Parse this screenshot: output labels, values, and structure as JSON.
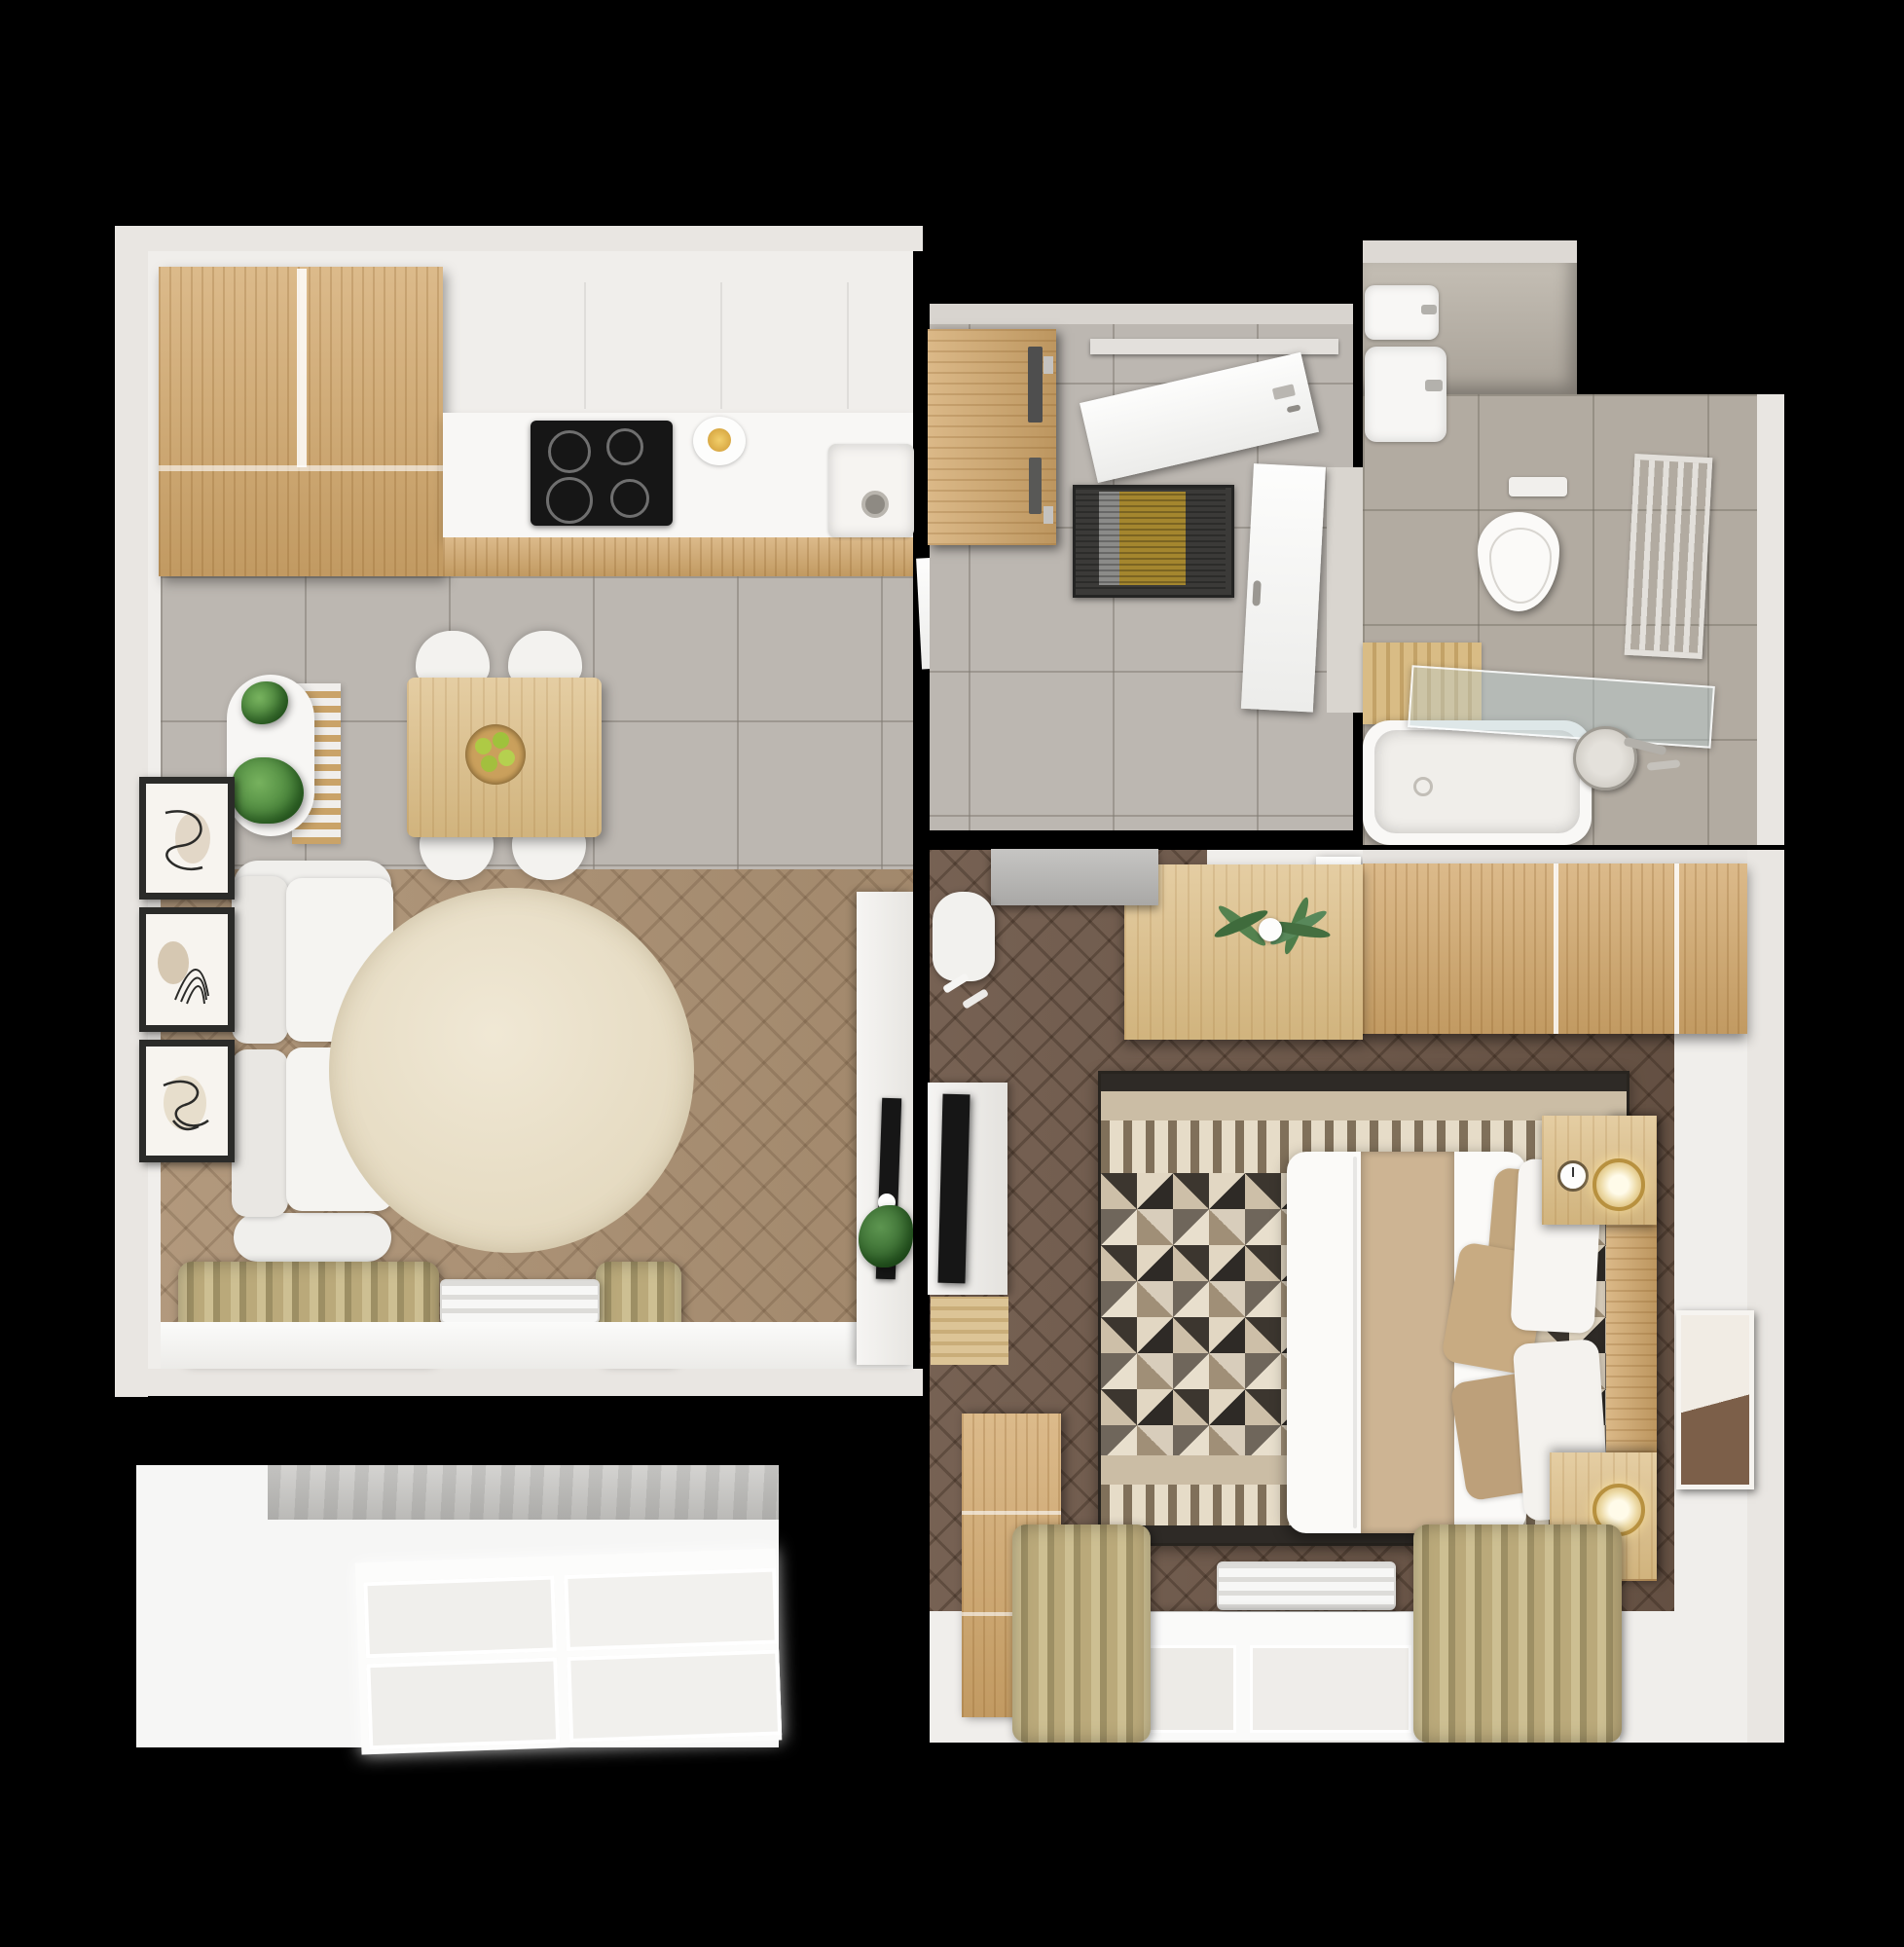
{
  "scene": {
    "type": "top-down 3d rendered apartment floor plan",
    "background": "#000000",
    "rooms_count": 5
  },
  "palette": {
    "bg": "#000000",
    "wall_face": "#e9e6e2",
    "room_wall": "#f0eeeb",
    "tile": "#bcb7b1",
    "bath_tile": "#b2aba1",
    "wood_cabinet": "#d2a76a",
    "wood_desk": "#dcbd84",
    "wood_floor_light": "#ac9173",
    "wood_floor_dark": "#6f594a",
    "counter": "#f8f7f5",
    "appliance_black": "#161616",
    "sofa_white": "#f3f2ef",
    "rug_cream": "#ebe2cd",
    "rug_base": "#d8cdbb",
    "rug_dark": "#2e2a26",
    "bed_white": "#fbfaf8",
    "bed_beige": "#cdb493",
    "pillow_beige": "#c2a67e",
    "curtain_olive": "#b1a274",
    "mat_dark": "#3b3a38",
    "mat_gold": "#b08f2e",
    "mat_gray": "#9a9a98",
    "plant_green": "#4c8040",
    "radiator_white": "#f6f6f5",
    "glass": "#c8dade"
  },
  "rooms": {
    "living_kitchen": {
      "floors": [
        "gray-ceramic-tile",
        "light-chevron-parquet"
      ],
      "objects": [
        "upper-wood-cabinets",
        "white-countertop",
        "induction-cooktop",
        "kitchen-sink",
        "breakfast-plate",
        "dining-table",
        "fruit-bowl-with-apples",
        "dining-chairs-x4",
        "white-console",
        "wood-bench",
        "potted-plants-x2",
        "white-sofa",
        "round-cream-rug",
        "wall-art-frames-x3",
        "window-radiator",
        "olive-curtains",
        "tv-sideboard",
        "living-tv",
        "monstera-plant",
        "window-sill"
      ]
    },
    "hallway": {
      "floors": [
        "gray-ceramic-tile"
      ],
      "objects": [
        "entry-door-open",
        "door-frame",
        "wood-wardrobe",
        "striped-doormat",
        "bathroom-door-open",
        "kitchen-door-open"
      ]
    },
    "bathroom": {
      "floors": [
        "warm-gray-tile"
      ],
      "objects": [
        "vanity-ledge",
        "washbasin",
        "second-basin",
        "wall-hung-toilet",
        "flush-plate",
        "towel-radiator",
        "wooden-bath-mat",
        "bathtub",
        "glass-shower-screen",
        "shower-head",
        "bath-faucet"
      ]
    },
    "bedroom": {
      "floors": [
        "dark-chevron-parquet"
      ],
      "objects": [
        "sliding-wardrobe",
        "wood-desk",
        "palm-plant",
        "gray-console-desk",
        "desk-chair",
        "wall-hooks",
        "tv-cabinet",
        "bedroom-tv",
        "wood-bench-mat",
        "wood-dresser",
        "geometric-rug",
        "double-bed",
        "beige-blanket",
        "pillows-beige-x3",
        "pillows-white-x2",
        "wood-headboard",
        "headboard-shelf-top",
        "headboard-shelf-bottom",
        "bedside-lamps-x2",
        "alarm-clock",
        "window-radiator",
        "window",
        "olive-curtains-x2",
        "wall-picture",
        "open-white-door"
      ]
    },
    "balcony": {
      "floors": [
        "white-screed"
      ],
      "objects": [
        "concrete-strip",
        "glazed-balcony-window"
      ]
    }
  }
}
